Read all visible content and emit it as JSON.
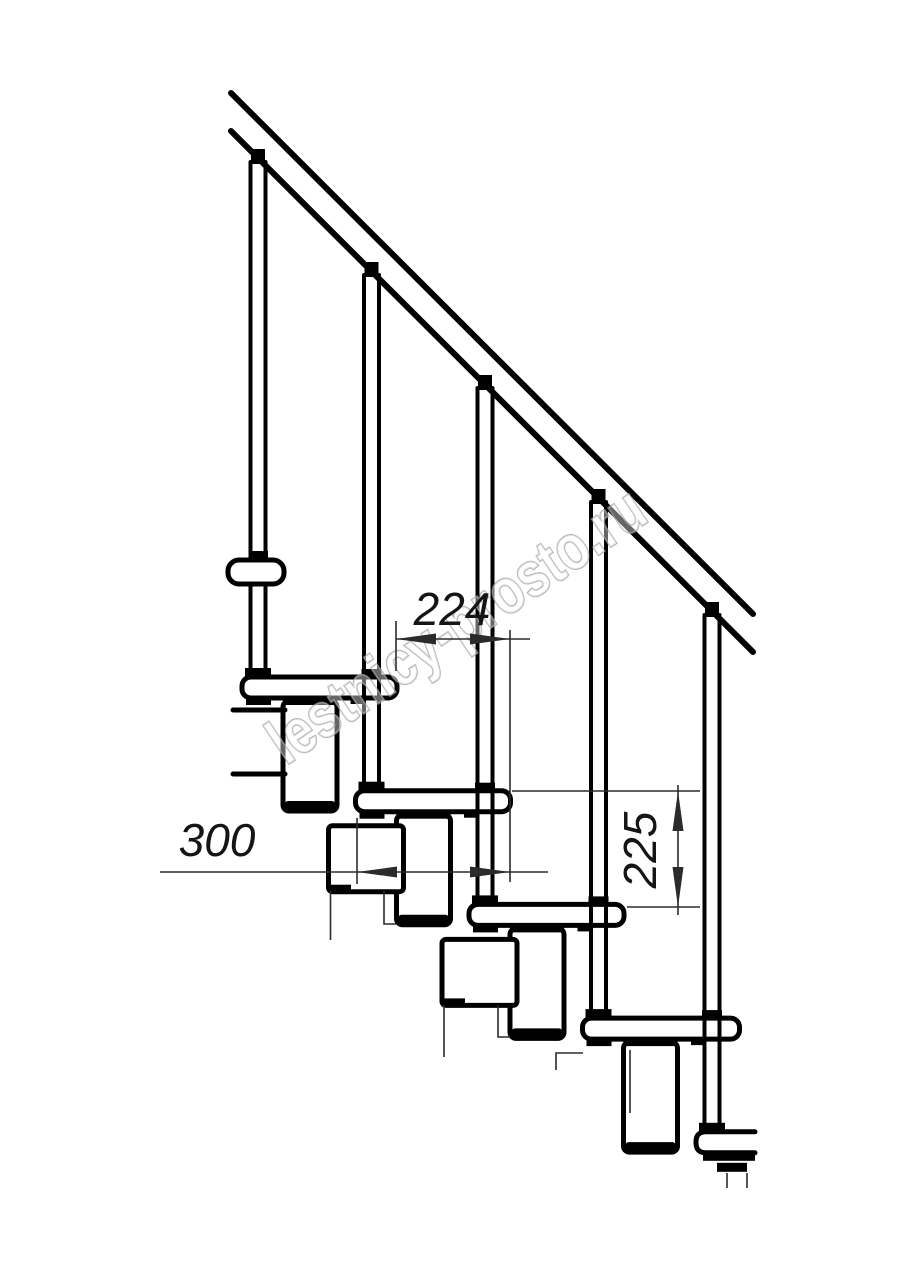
{
  "dimensions": {
    "step_run": {
      "value": "224"
    },
    "tread_depth": {
      "value": "300"
    },
    "step_rise": {
      "value": "225"
    }
  },
  "watermark": {
    "text": "lestnicy-prosto.ru"
  },
  "colors": {
    "line": "#000000",
    "dimension": "#2b2b2b",
    "watermark": "#9b9b9b",
    "background": "#ffffff"
  }
}
